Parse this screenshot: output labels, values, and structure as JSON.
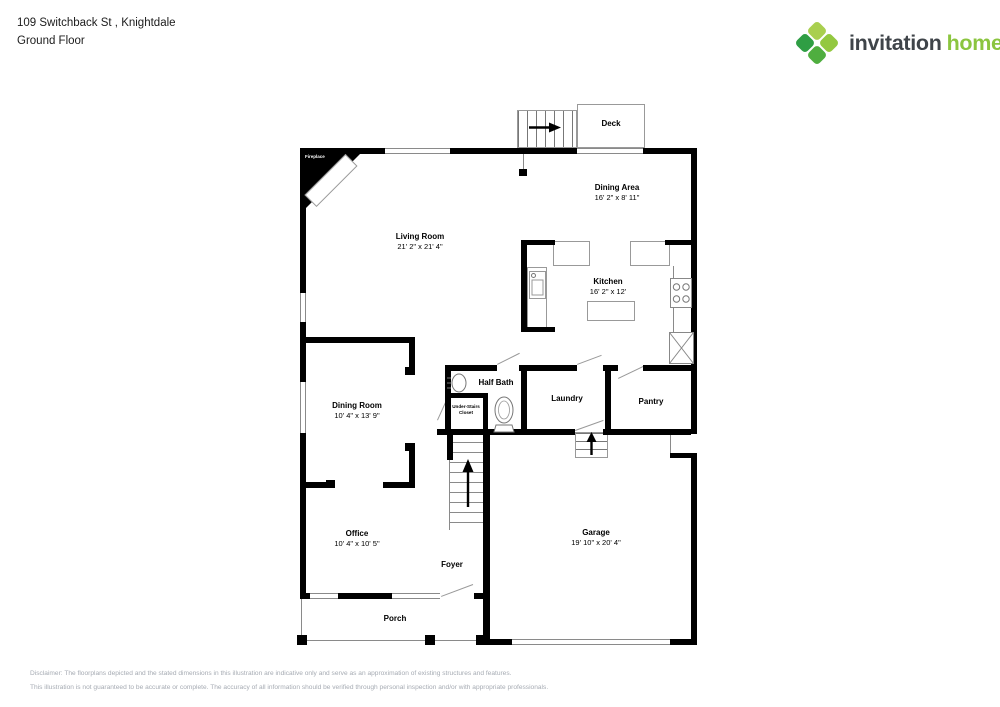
{
  "header": {
    "address": "109 Switchback St , Knightdale",
    "floor": "Ground Floor"
  },
  "logo": {
    "brand_first": "invitation",
    "brand_second": "homes",
    "trademark": "™",
    "colors": {
      "text_dark": "#3f4449",
      "text_green": "#8bc53f",
      "pin_top": "#a9cf4f",
      "pin_right": "#93c840",
      "pin_left": "#2f9e44",
      "pin_bottom": "#4fae3f"
    }
  },
  "rooms": {
    "living": {
      "name": "Living Room",
      "dims": "21' 2\" x 21' 4\""
    },
    "dining_area": {
      "name": "Dining Area",
      "dims": "16' 2\" x 8' 11\""
    },
    "kitchen": {
      "name": "Kitchen",
      "dims": "16' 2\" x 12'"
    },
    "dining_room": {
      "name": "Dining Room",
      "dims": "10' 4\" x 13' 9\""
    },
    "office": {
      "name": "Office",
      "dims": "10' 4\" x 10' 5\""
    },
    "garage": {
      "name": "Garage",
      "dims": "19' 10\" x 20' 4\""
    },
    "half_bath": {
      "name": "Half Bath"
    },
    "laundry": {
      "name": "Laundry"
    },
    "pantry": {
      "name": "Pantry"
    },
    "foyer": {
      "name": "Foyer"
    },
    "porch": {
      "name": "Porch"
    },
    "deck": {
      "name": "Deck"
    },
    "closet": {
      "line1": "Under-Stairs",
      "line2": "Closet"
    },
    "fireplace": {
      "name": "Fireplace"
    }
  },
  "disclaimer": {
    "line1": "Disclaimer: The floorplans depicted and the stated dimensions in this illustration are indicative only and serve as an approximation of existing structures and features.",
    "line2": "This illustration is not guaranteed to be accurate or complete. The accuracy of all information should be verified through personal inspection and/or with appropriate professionals."
  }
}
